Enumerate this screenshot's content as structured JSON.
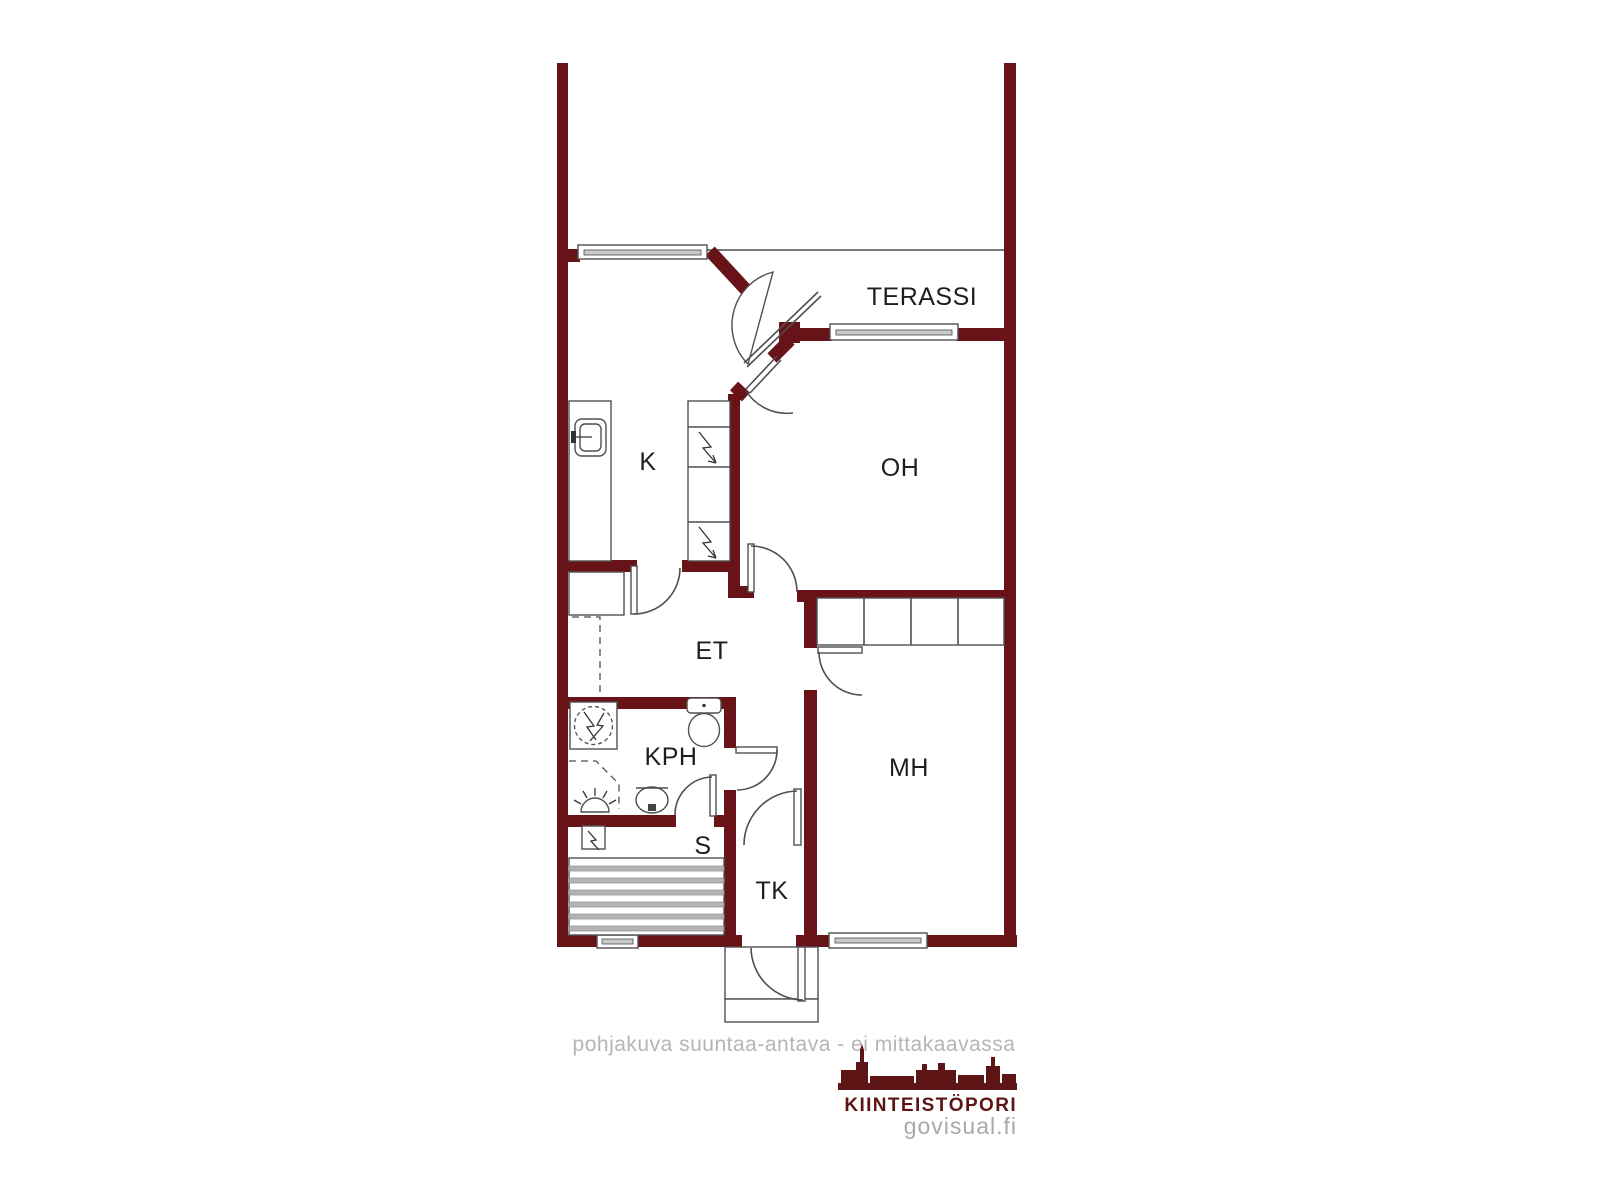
{
  "floorplan": {
    "rooms": [
      {
        "id": "terassi",
        "label": "TERASSI"
      },
      {
        "id": "k",
        "label": "K"
      },
      {
        "id": "oh",
        "label": "OH"
      },
      {
        "id": "et",
        "label": "ET"
      },
      {
        "id": "kph",
        "label": "KPH"
      },
      {
        "id": "mh",
        "label": "MH"
      },
      {
        "id": "s",
        "label": "S"
      },
      {
        "id": "tk",
        "label": "TK"
      }
    ],
    "disclaimer": "pohjakuva suuntaa-antava - ei mittakaavassa",
    "brand": {
      "name": "KIINTEISTÖPORI",
      "site": "govisual.fi"
    },
    "colors": {
      "wall": "#681318",
      "line": "#4f4f4f",
      "label": "#1d1d1d",
      "disclaimer": "#b5b5b5",
      "brand": "#5c1414",
      "site": "#a9a9a9",
      "bench": "#b4b4b4"
    }
  }
}
